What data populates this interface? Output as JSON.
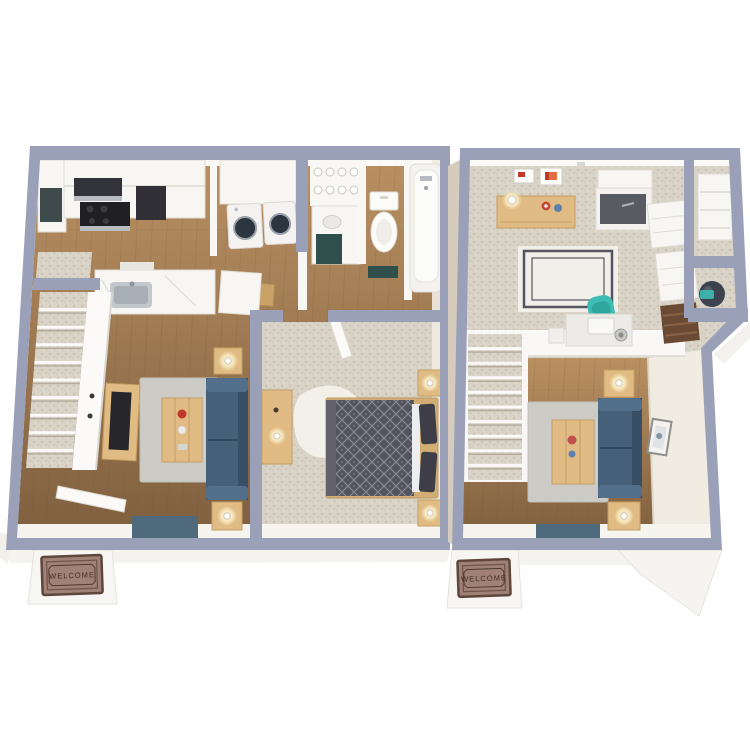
{
  "scene": {
    "description": "3D top-down rendering of two apartment floor plans side by side, each with an entry welcome mat",
    "background_color": "#ffffff"
  },
  "plans": [
    {
      "name": "first-floor-plan",
      "position": "left",
      "welcome_mat": {
        "text": "WELCOME"
      },
      "rooms": [
        {
          "name": "kitchen",
          "floor": "wood",
          "items": [
            "range-with-hood",
            "refrigerator",
            "upper-cabinets",
            "sink-peninsula",
            "dining-table-with-chair"
          ]
        },
        {
          "name": "laundry-closet",
          "floor": "wood",
          "items": [
            "washer",
            "dryer"
          ]
        },
        {
          "name": "bathroom",
          "floor": "wood",
          "items": [
            "vanity-with-lights",
            "toilet",
            "bathtub",
            "bath-mat"
          ]
        },
        {
          "name": "bedroom",
          "floor": "carpet",
          "items": [
            "bed",
            "nightstand-with-lamp",
            "nightstand-with-lamp",
            "dresser-with-lamp",
            "shag-rug"
          ]
        },
        {
          "name": "living-room",
          "floor": "wood",
          "items": [
            "sofa",
            "coffee-table",
            "end-table-with-lamp",
            "end-table-with-lamp",
            "tv-console",
            "media-bench",
            "area-rug",
            "front-door"
          ]
        },
        {
          "name": "staircase",
          "floor": "carpet",
          "items": [
            "carpeted-stairs",
            "half-wall"
          ]
        }
      ]
    },
    {
      "name": "second-floor-plan",
      "position": "right",
      "welcome_mat": {
        "text": "WELCOME"
      },
      "rooms": [
        {
          "name": "loft-office",
          "floor": "carpet",
          "items": [
            "console-table-with-lamp",
            "wall-art",
            "built-in-cabinet",
            "drawer-chest",
            "drawer-chest",
            "ladder-shelf",
            "bordered-rug",
            "desk",
            "office-chair",
            "coffee-tumbler"
          ]
        },
        {
          "name": "closet",
          "floor": "carpet",
          "items": [
            "shelving"
          ]
        },
        {
          "name": "utility-closet",
          "floor": "carpet",
          "items": [
            "water-heater"
          ]
        },
        {
          "name": "living-room",
          "floor": "wood",
          "items": [
            "sofa",
            "coffee-table",
            "end-table-with-lamp",
            "end-table-with-lamp",
            "framed-art",
            "media-bench",
            "area-rug"
          ]
        },
        {
          "name": "staircase",
          "floor": "carpet",
          "items": [
            "carpeted-stairs"
          ]
        }
      ]
    }
  ],
  "colors": {
    "bg": "#ffffff",
    "wall_cap": "#9aa0b8",
    "wall_face": "#f8f7f4",
    "wall_shade": "#e9e6df",
    "wall_cream": "#f0ece2",
    "wood_top": "#b99062",
    "wood_bottom": "#7f5f3f",
    "plank_line": "#6f5236",
    "carpet": "#d8d3c6",
    "carpet_dot": "#c0b8a6",
    "sofa": "#466079",
    "sofa_dark": "#384f66",
    "sofa_light": "#52708c",
    "wood_furniture": "#e0bc84",
    "wood_furniture_edge": "#c49e63",
    "dark_wood": "#6b4a33",
    "bed_frame": "#d2ad74",
    "duvet": "#54545e",
    "duvet_line": "#9c9ca8",
    "pillow": "#3e3e48",
    "rug_gray": "#cccbc6",
    "rug_white": "#f4f2ec",
    "rug_border": "#54545c",
    "mat": "#a08175",
    "mat_border": "#5e463c",
    "mat_text": "#3f2f28",
    "teal_chair": "#3cbcb2",
    "appliance_dark": "#303036",
    "steel": "#b7bcc2",
    "bench": "#4e6a7c",
    "bath_teal": "#2e4f4c",
    "water_heater": "#3c434e",
    "slab": "#f4f3ef",
    "accent_red": "#c0392b",
    "accent_blue": "#5b7fae",
    "lamp_glow": "#f7e7bf"
  }
}
